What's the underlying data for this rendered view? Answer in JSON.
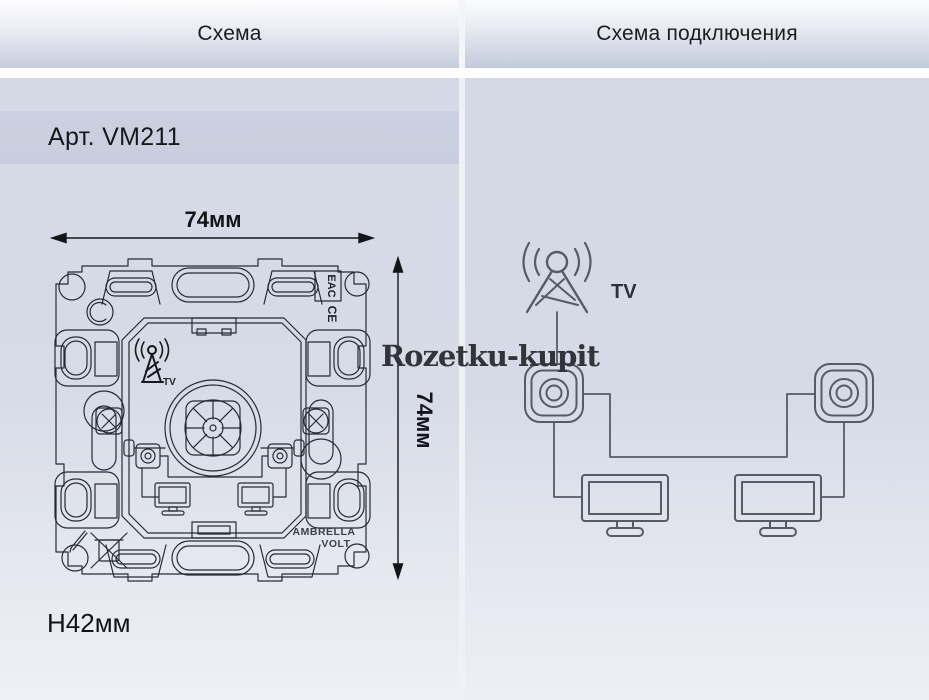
{
  "header": {
    "left_tab": "Схема",
    "right_tab": "Схема подключения"
  },
  "left_panel": {
    "article": "Арт. VM211",
    "width_dim": "74мм",
    "height_dim": "74мм",
    "depth_dim": "H42мм",
    "drawing": {
      "eac_mark": "EAC",
      "ce_mark": "CE",
      "antenna_label": "TV",
      "brand_line1": "AMBRELLA",
      "brand_line2": "VOLT"
    }
  },
  "right_panel": {
    "antenna_label": "TV"
  },
  "watermark": "Rozetku-kupit",
  "colors": {
    "panel_top": "#d5d9e5",
    "panel_bottom": "#eef0f5",
    "band": "#c9cfde",
    "drawing_line": "#262b35",
    "diagram_line": "#565b66"
  }
}
